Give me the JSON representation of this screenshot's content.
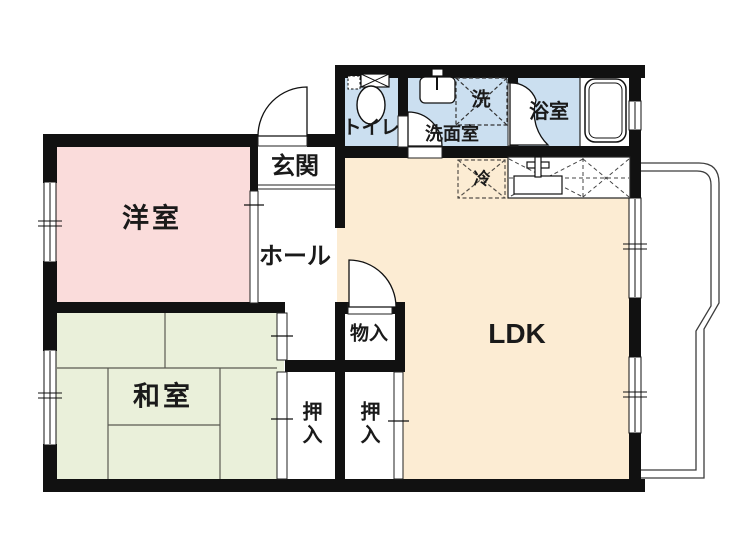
{
  "floorplan": {
    "title": "2LDK apartment floor plan",
    "rooms": {
      "western_room": {
        "label": "洋室",
        "color": "#fadcdb"
      },
      "japanese_room": {
        "label": "和室",
        "color": "#eaf0da"
      },
      "ldk": {
        "label": "LDK",
        "color": "#fcecd3"
      },
      "entrance": {
        "label": "玄関",
        "color": "#ffffff"
      },
      "hall": {
        "label": "ホール",
        "color": "#ffffff"
      },
      "toilet": {
        "label": "トイレ",
        "color": "#cbdff0"
      },
      "washroom": {
        "label": "洗面室",
        "color": "#cbdff0"
      },
      "bathroom": {
        "label": "浴室",
        "color": "#cbdff0"
      },
      "storage": {
        "label": "物入",
        "color": "#ffffff"
      },
      "closet_left": {
        "label": "押入",
        "color": "#ffffff"
      },
      "closet_right": {
        "label": "押入",
        "color": "#ffffff"
      }
    },
    "fixtures": {
      "washing_machine": {
        "label": "洗"
      },
      "refrigerator": {
        "label": "冷"
      }
    },
    "wall_color": "#111111"
  }
}
